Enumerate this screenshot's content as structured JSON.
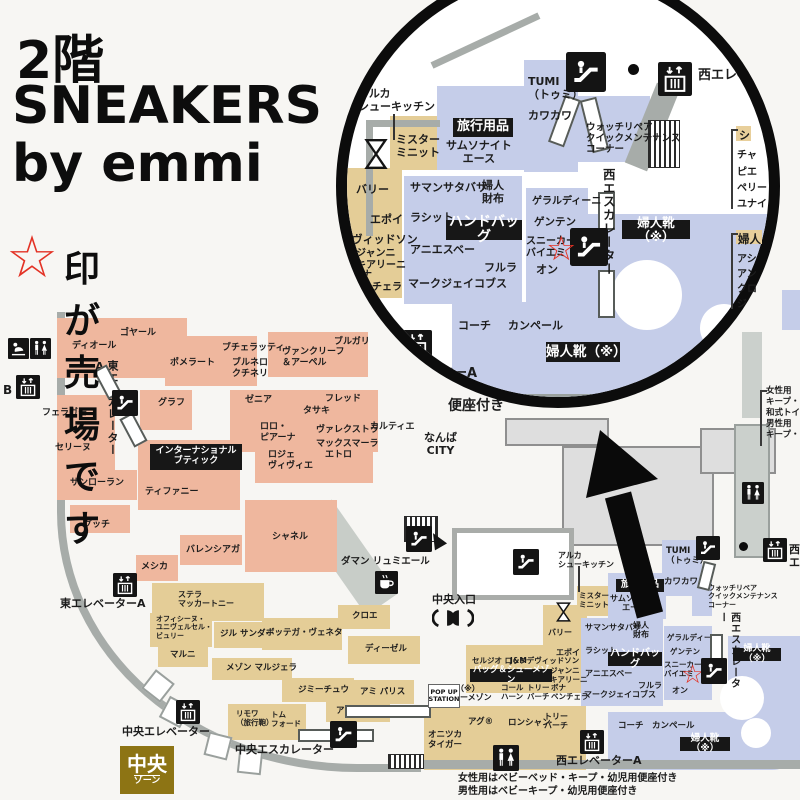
{
  "header": {
    "floor": "2階",
    "title1": "SNEAKERS",
    "title2": "by emmi",
    "star": "☆",
    "note": "印が売場です"
  },
  "shops": {
    "dior": "ディオール",
    "goyard": "ゴヤール",
    "pomellato": "ポメラート",
    "buccellati": "ブチェラッティ",
    "brunello": "ブルネロ\nクチネリ",
    "vancleef": "ヴァンクリーフ\n＆アーペル",
    "bulgari": "ブルガリ",
    "graff": "グラフ",
    "zegna": "ゼニア",
    "fred": "フレッド",
    "tasaki": "タサキ",
    "loro": "ロロ・\nピアーナ",
    "valextra": "ヴァレクストラ",
    "maxmara": "マックスマーラ",
    "cartier": "カルティエ",
    "etro": "エトロ",
    "roger": "ロジェ\nヴィヴィエ",
    "ferragamo": "フェラガモ",
    "celine": "セリーヌ",
    "saintlaurent": "サンローラン",
    "gucci": "グッチ",
    "tiffany": "ティファニー",
    "chanel": "シャネル",
    "balenciaga": "バレンシアガ",
    "messika": "メシカ",
    "stella": "ステラ\nマッカートニー",
    "officine": "オフィシーヌ・\nユニヴェルセル・\nビュリー",
    "jilsander": "ジル サンダー",
    "marni": "マルニ",
    "margiela": "メゾン マルジェラ",
    "jimmychoo": "ジミーチュウ",
    "rimowa": "リモワ\n（旅行鞄）",
    "tomford": "トム\nフォード",
    "bottega": "ボッテガ・ヴェネタ",
    "chloe": "クロエ",
    "diesel": "ディーゼル",
    "ami": "アミ パリス",
    "anteprima": "アンテプリマ",
    "ugg": "アグ®",
    "longchamp": "ロンシャン",
    "toryburch": "トリー\nバーチ",
    "onitsuka": "オニツカ\nタイガー",
    "sergiorossi": "セルジオ ロッシ",
    "jmdavidson": "J&Mデヴィッドソン",
    "gianni": "ジャンニ\nキアリーニ",
    "colehaan": "コール\nハーン",
    "bona": "ボナ\nベンチェラ",
    "bally": "バリー",
    "epoi": "エポイ",
    "mrminit": "ミスター\nミニット",
    "arca": "アルカ\nシューキッチン",
    "samsonite": "サムソナイト\nエース",
    "tumi": "TUMI\n（トゥミ）",
    "kawakawa": "カワカワ",
    "watch": "ウォッチリペア\nクイックメンテナンス\nコーナー",
    "samantha": "サマンサタバサ",
    "fujinsaifu": "婦人\n財布",
    "russet": "ラシット",
    "agnesb": "アニエスベー",
    "furla": "フルラ",
    "marcjacobs": "マークジェイコブス",
    "gherardini": "ゲラルディーニ",
    "genten": "ゲンテン",
    "sneakers": "スニーカーズ\nバイエミ",
    "on": "オン",
    "coach": "コーチ",
    "camper": "カンペール"
  },
  "labels": {
    "travel": "旅行用品",
    "handbag": "ハンドバッグ",
    "bagshoe": "バッグ＆シューメゾン",
    "bagshoe_cut": "ン",
    "fujinkutsu": "婦人靴（※）",
    "intl": "インターナショナル\nブティック",
    "shoemaison": "（※）\nシューメゾン",
    "popup": "POP UP\nSTATION",
    "zone": "中央\nゾーン"
  },
  "facilities": {
    "east_esc_a": "東エスカレーターA",
    "east_elev_a": "東エレベーターA",
    "east_elev_b_cut": "B",
    "chuo_elev": "中央エレベーター",
    "chuo_esc": "中央エスカレーター",
    "chuo_entrance": "中央入口",
    "nishi_esc": "西エスカレーター",
    "nishi_elev": "西エレベーター",
    "nishi_elev_a": "西エレベーターA",
    "nishi_cut": "西エ",
    "damann": "ダマン リュミエール",
    "namba": "なんば\nCITY",
    "benza": "便座付き",
    "note_f": "女性用はベビーベッド・キープ・幼児用便座付き",
    "note_m": "男性用はベビーキープ・幼児用便座付き",
    "right_note": "女性用\nキープ・\n和式トイ\n男性用\nキープ・"
  },
  "side_lists": {
    "l1h": "シ",
    "l1": [
      "チャ",
      "ピエ",
      "ペリー",
      "ユナイ"
    ],
    "l2h": "婦人",
    "l2": [
      "アシ",
      "アン",
      "クロ",
      "ジ"
    ]
  },
  "colors": {
    "salmon": "#efb79e",
    "tan": "#e4cd97",
    "blue": "#c5cde9",
    "wall": "#a7aca9",
    "label_bg": "#171717",
    "star_red": "#e33225",
    "zone_gold": "#8d7414"
  }
}
